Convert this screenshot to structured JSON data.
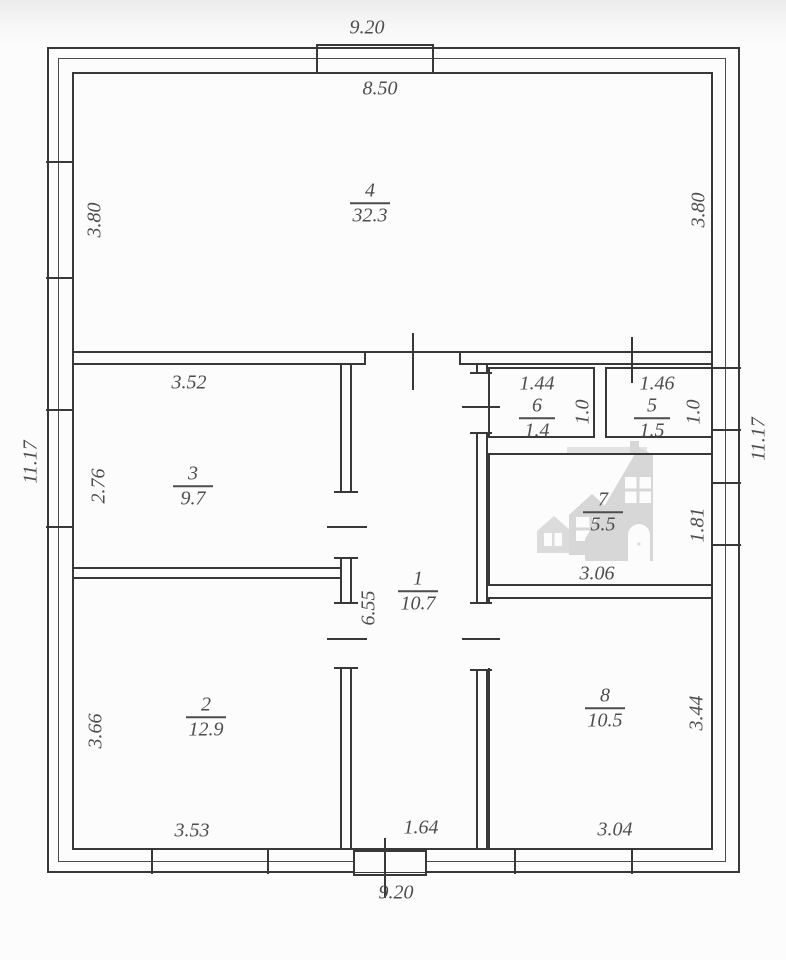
{
  "dimensions": {
    "top_overall": "9.20",
    "bottom_overall": "9.20",
    "left_overall": "11.17",
    "right_overall": "11.17",
    "room4_width": "8.50",
    "room4_left": "3.80",
    "room4_right": "3.80",
    "room3_width": "3.52",
    "room3_height": "2.76",
    "room2_width": "3.53",
    "room2_height": "3.66",
    "room1_height": "6.55",
    "room1_width": "1.64",
    "room6_width": "1.44",
    "room6_height": "1.0",
    "room5_width": "1.46",
    "room5_height": "1.0",
    "room7_width": "3.06",
    "room7_height": "1.81",
    "room8_width": "3.04",
    "room8_height": "3.44"
  },
  "rooms": {
    "r1": {
      "number": "1",
      "area": "10.7"
    },
    "r2": {
      "number": "2",
      "area": "12.9"
    },
    "r3": {
      "number": "3",
      "area": "9.7"
    },
    "r4": {
      "number": "4",
      "area": "32.3"
    },
    "r5": {
      "number": "5",
      "area": "1.5"
    },
    "r6": {
      "number": "6",
      "area": "1.4"
    },
    "r7": {
      "number": "7",
      "area": "5.5"
    },
    "r8": {
      "number": "8",
      "area": "10.5"
    }
  },
  "colors": {
    "line": "#383838",
    "text": "#4d4d4d",
    "watermark": "#d8d8d8"
  }
}
